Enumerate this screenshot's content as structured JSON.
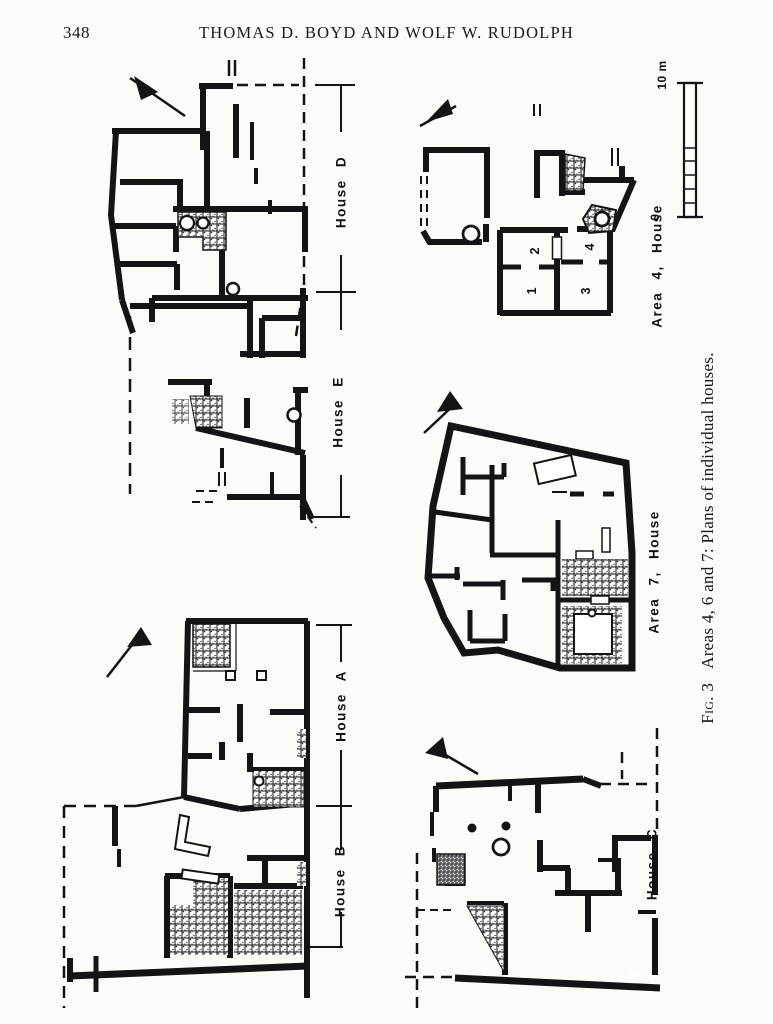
{
  "page": {
    "number": "348",
    "running_head": "THOMAS D. BOYD AND WOLF W. RUDOLPH"
  },
  "figure": {
    "caption": {
      "fig_label": "Fig. 3",
      "text": "Areas 4, 6 and 7: Plans of individual houses."
    },
    "scale_bar": {
      "max_label": "10 m",
      "zero_label": "0"
    },
    "labels": {
      "house_d": "House D",
      "house_e": "House E",
      "house_a": "House A",
      "house_b": "House B",
      "house_c": "House C",
      "area4": "Area 4, House",
      "area7": "Area 7, House"
    },
    "area4_rooms": [
      "1",
      "2",
      "3",
      "4"
    ],
    "icons": {
      "north_arrow": "north-arrow",
      "wall_fill": "#141414",
      "paper": "#fcfbf8"
    }
  }
}
